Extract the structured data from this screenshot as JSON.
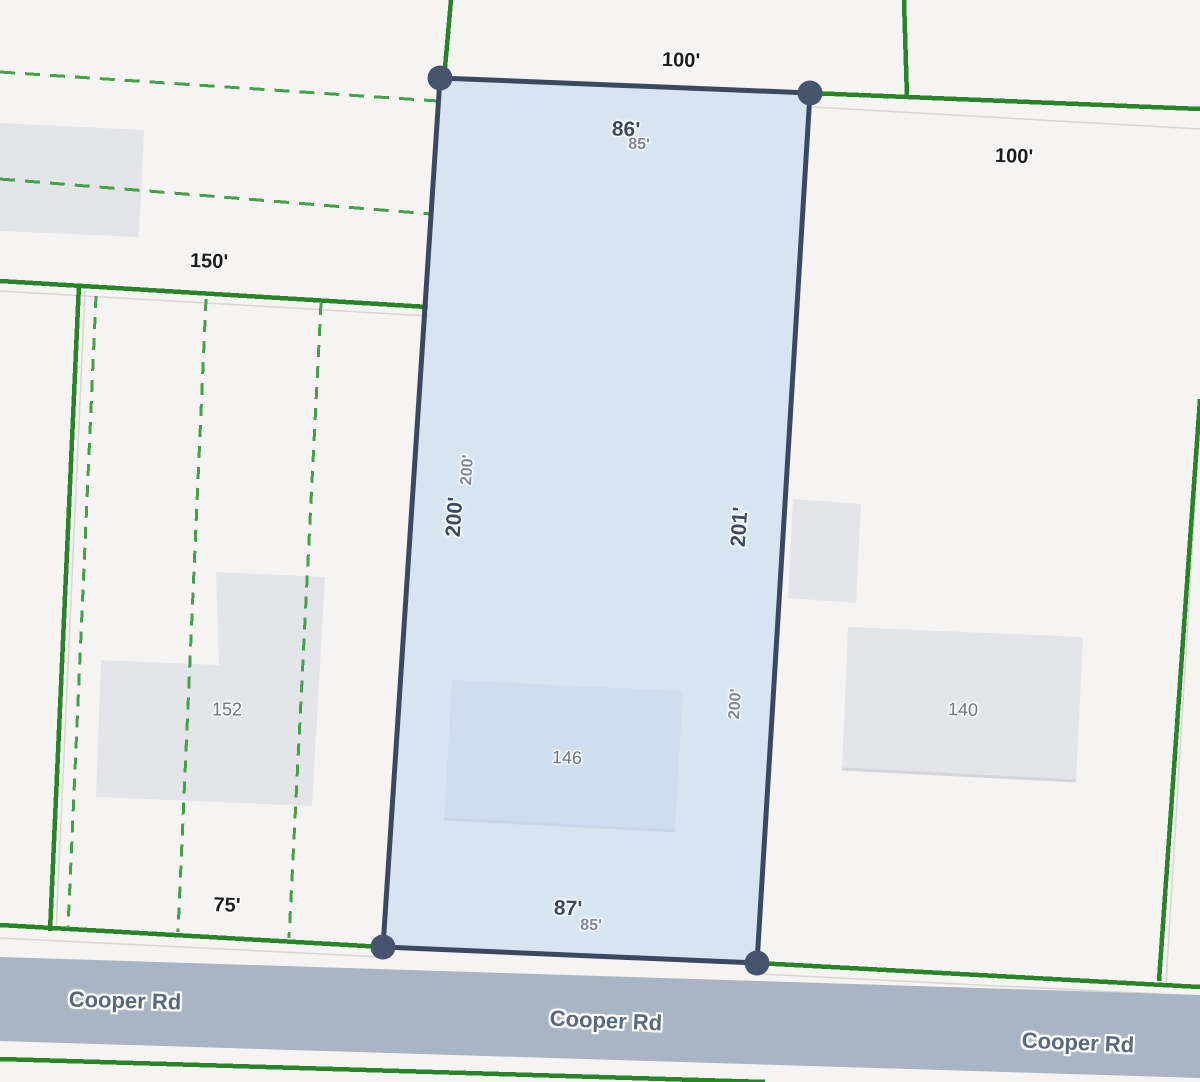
{
  "map": {
    "road_labels": [
      "Cooper Rd",
      "Cooper Rd",
      "Cooper Rd"
    ],
    "selected_parcel": {
      "house_number": "146",
      "rear_width": "86'",
      "front_width": "87'",
      "left_depth": "200'",
      "right_depth": "201'"
    },
    "base_map_dimensions": {
      "rear_width": "85'",
      "front_width": "85'",
      "left_depth": "200'",
      "right_depth": "200'"
    },
    "adjacent_lots": {
      "top_lot_width": "100'",
      "right_lot_width": "100'",
      "left_lot_depth": "150'",
      "left_lot_frontage": "75'",
      "left_house_number": "152",
      "right_house_number": "140"
    },
    "colors": {
      "background": "#f5f4f2",
      "selected_parcel_fill": "rgba(189,216,244,0.55)",
      "selected_parcel_border": "#3a4860",
      "vertex_handle": "#46556d",
      "boundary_green_solid": "#278427",
      "boundary_green_dashed": "#44a04a",
      "building_fill": "#e4e5e9",
      "road_fill": "#a9b5c4",
      "faint_line": "#d9d6d0"
    }
  }
}
